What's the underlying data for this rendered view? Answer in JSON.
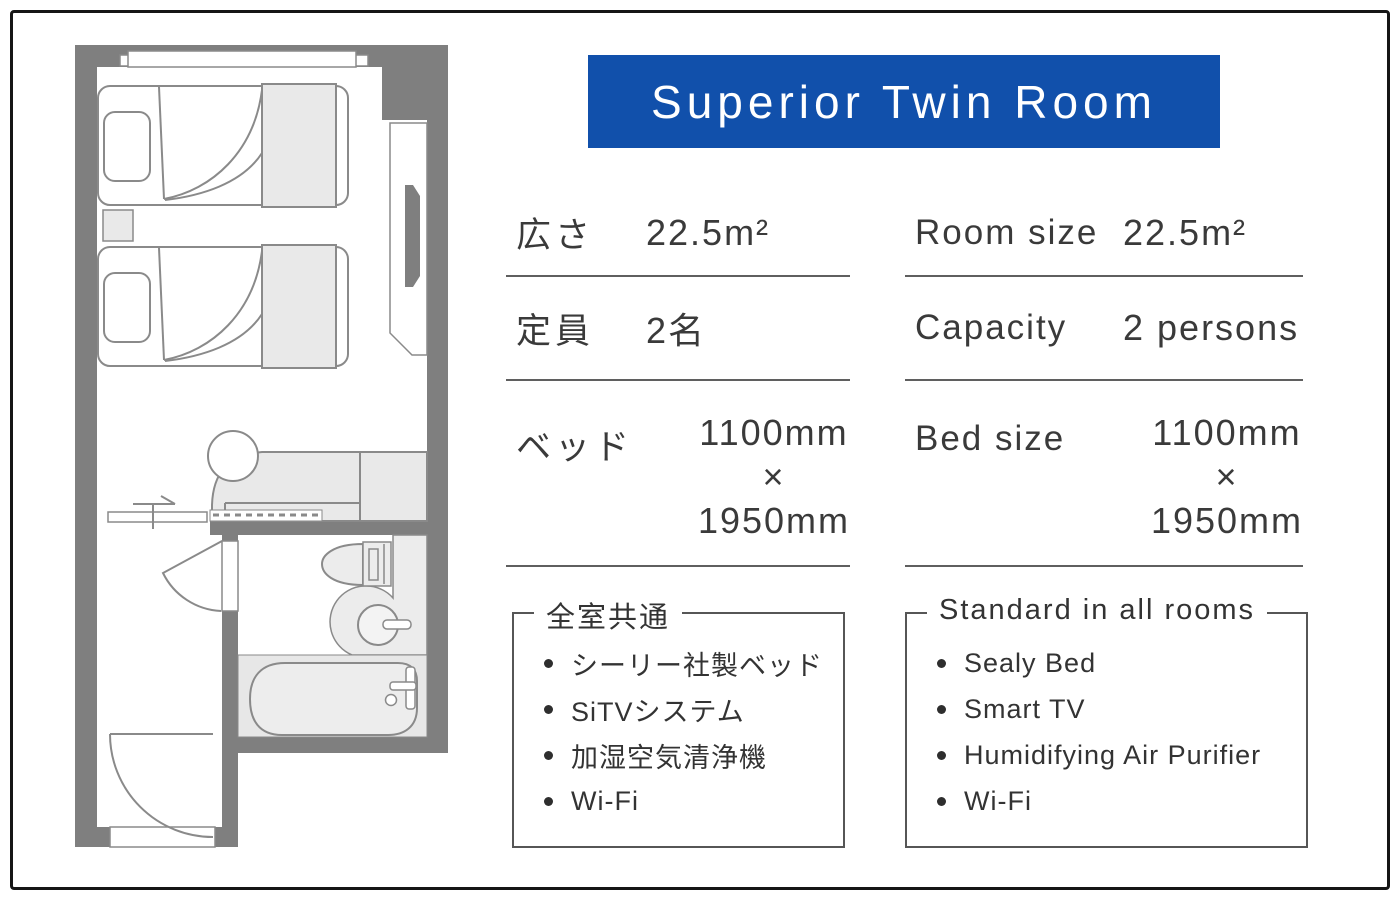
{
  "title": "Superior Twin Room",
  "colors": {
    "banner_blue": "#1150ab",
    "wall_gray": "#7f7f7f",
    "furniture_fill": "#eaeaea",
    "text": "#3a3a3a"
  },
  "floorplan": {
    "elements": [
      "window",
      "twin-bed-1",
      "twin-bed-2",
      "nightstand",
      "tv-cabinet",
      "tv",
      "sofa",
      "round-table",
      "sliding-door",
      "bathroom-door",
      "toilet",
      "sink-counter",
      "sink",
      "bathtub",
      "entrance-door"
    ]
  },
  "specs_jp": {
    "rows": [
      {
        "label": "広さ",
        "value": "22.5m²"
      },
      {
        "label": "定員",
        "value": "2名"
      },
      {
        "label": "ベッド",
        "value_lines": [
          "1100mm",
          "×",
          "1950mm"
        ]
      }
    ],
    "features_title": "全室共通",
    "features": [
      "シーリー社製ベッド",
      "SiTVシステム",
      "加湿空気清浄機",
      "Wi-Fi"
    ]
  },
  "specs_en": {
    "rows": [
      {
        "label": "Room size",
        "value": "22.5m²"
      },
      {
        "label": "Capacity",
        "value": "2 persons"
      },
      {
        "label": "Bed size",
        "value_lines": [
          "1100mm",
          "×",
          "1950mm"
        ]
      }
    ],
    "features_title": "Standard in all rooms",
    "features": [
      "Sealy Bed",
      "Smart TV",
      "Humidifying Air Purifier",
      "Wi-Fi"
    ]
  }
}
